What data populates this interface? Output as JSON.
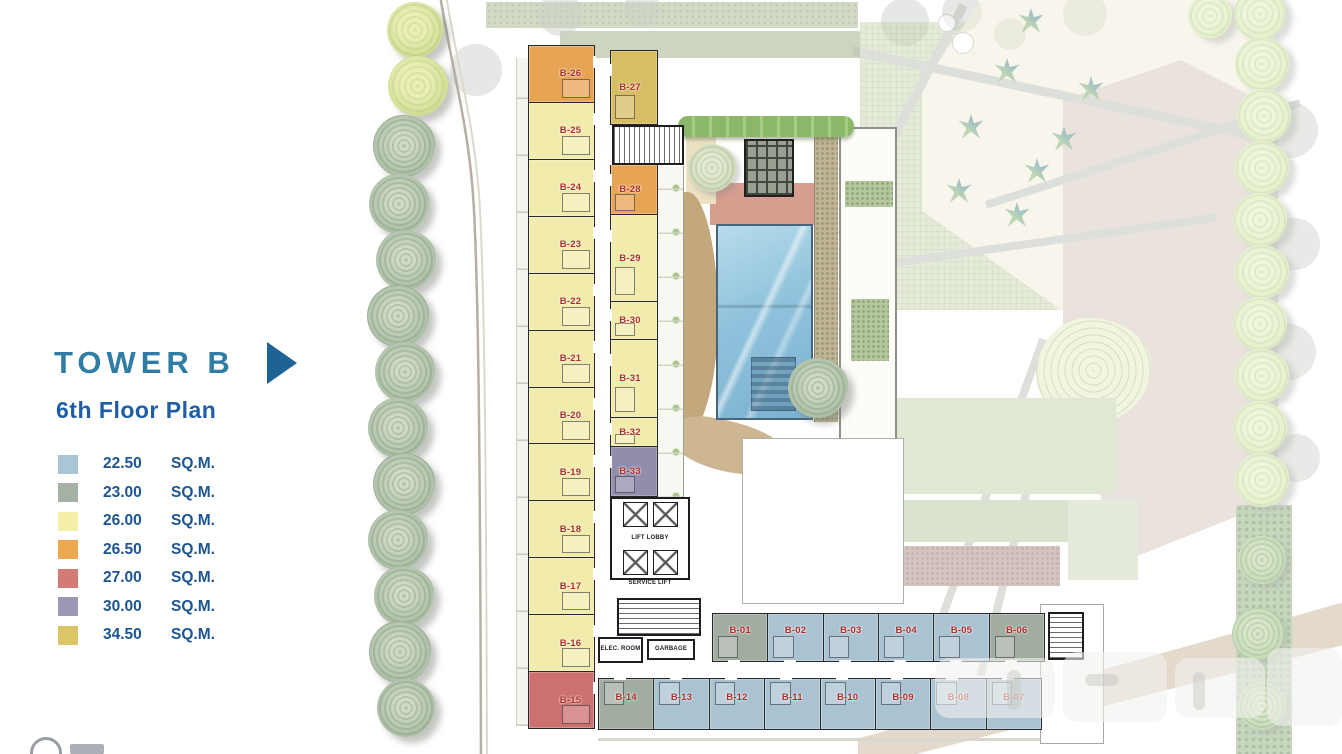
{
  "legend": {
    "title": "TOWER B",
    "subtitle": "6th Floor Plan",
    "items": [
      {
        "area": "22.50",
        "uom": "SQ.M.",
        "color": "#a9c6d6"
      },
      {
        "area": "23.00",
        "uom": "SQ.M.",
        "color": "#a6b1a6"
      },
      {
        "area": "26.00",
        "uom": "SQ.M.",
        "color": "#f3eeaa"
      },
      {
        "area": "26.50",
        "uom": "SQ.M.",
        "color": "#eca94f"
      },
      {
        "area": "27.00",
        "uom": "SQ.M.",
        "color": "#d47976"
      },
      {
        "area": "30.00",
        "uom": "SQ.M.",
        "color": "#9a98b4"
      },
      {
        "area": "34.50",
        "uom": "SQ.M.",
        "color": "#dbc566"
      }
    ]
  },
  "plan": {
    "unit_label_color": "#ad2e28",
    "area_colors": {
      "22.50": "#aac3d3",
      "23.00": "#a2ada1",
      "26.00": "#f1ecab",
      "26.50": "#e8a455",
      "27.00": "#cc7170",
      "30.00": "#908eab",
      "34.50": "#d7bd64"
    },
    "core": {
      "lift_lobby": "LIFT LOBBY",
      "service_lift": "SERVICE LIFT",
      "elec_room": "ELEC. ROOM",
      "garbage": "GARBAGE"
    },
    "west_units": [
      {
        "label": "B-26",
        "area": "26.50"
      },
      {
        "label": "B-25",
        "area": "26.00"
      },
      {
        "label": "B-24",
        "area": "26.00"
      },
      {
        "label": "B-23",
        "area": "26.00"
      },
      {
        "label": "B-22",
        "area": "26.00"
      },
      {
        "label": "B-21",
        "area": "26.00"
      },
      {
        "label": "B-20",
        "area": "26.00"
      },
      {
        "label": "B-19",
        "area": "26.00"
      },
      {
        "label": "B-18",
        "area": "26.00"
      },
      {
        "label": "B-17",
        "area": "26.00"
      },
      {
        "label": "B-16",
        "area": "26.00"
      },
      {
        "label": "B-15",
        "area": "27.00"
      }
    ],
    "east_units": [
      {
        "label": "B-27",
        "area": "34.50"
      },
      {
        "label": "B-28",
        "area": "26.50"
      },
      {
        "label": "B-29",
        "area": "26.00"
      },
      {
        "label": "B-30",
        "area": "26.00"
      },
      {
        "label": "B-31",
        "area": "26.00"
      },
      {
        "label": "B-32",
        "area": "26.00"
      },
      {
        "label": "B-33",
        "area": "30.00"
      }
    ],
    "south_upper_units": [
      {
        "label": "B-01",
        "area": "23.00"
      },
      {
        "label": "B-02",
        "area": "22.50"
      },
      {
        "label": "B-03",
        "area": "22.50"
      },
      {
        "label": "B-04",
        "area": "22.50"
      },
      {
        "label": "B-05",
        "area": "22.50"
      },
      {
        "label": "B-06",
        "area": "23.00"
      }
    ],
    "south_lower_units": [
      {
        "label": "B-14",
        "area": "23.00"
      },
      {
        "label": "B-13",
        "area": "22.50"
      },
      {
        "label": "B-12",
        "area": "22.50"
      },
      {
        "label": "B-11",
        "area": "22.50"
      },
      {
        "label": "B-10",
        "area": "22.50"
      },
      {
        "label": "B-09",
        "area": "22.50"
      },
      {
        "label": "B-08",
        "area": "22.50"
      },
      {
        "label": "B-07",
        "area": "22.50"
      }
    ]
  }
}
